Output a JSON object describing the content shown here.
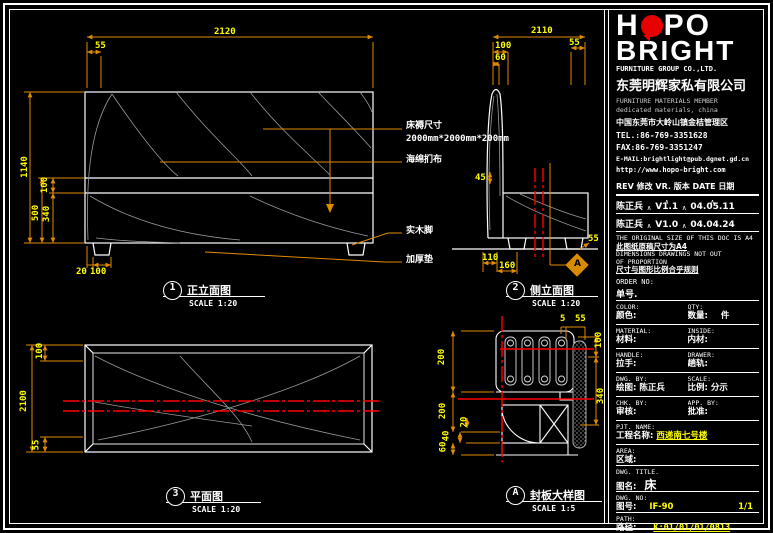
{
  "logo": {
    "l1a": "H",
    "l1b": "PO",
    "line2": "BRIGHT",
    "subtitle": "FURNITURE GROUP CO.,LTD.",
    "company_cn": "东莞明辉家私有限公司",
    "desc1": "FURNITURE MATERIALS MEMBER",
    "desc2": "dedicated materials, china",
    "address": "中国东莞市大岭山镇金桔管理区",
    "tel": "TEL.:86-769-3351628",
    "fax": "FAX:86-769-3351247",
    "email": "E-MAIL:brightlight@pub.dgnet.gd.cn",
    "web": "http://www.hopo-bright.com"
  },
  "rev": {
    "header": "REV 修改   VR. 版本   DATE 日期",
    "caret": "∧",
    "rows": [
      {
        "by": "陈正兵",
        "ver": "V1.1",
        "date": "04.05.11"
      },
      {
        "by": "陈正兵",
        "ver": "V1.0",
        "date": "04.04.24"
      }
    ]
  },
  "notes": {
    "en1": "THE ORIGINAL SIZE OF THIS DOC IS A4",
    "cn1": "此图纸原稿尺寸为A4",
    "en2": "DIMENSIONS DRAWINGS NOT OUT",
    "en3": "OF PROPORTION",
    "cn2": "尺寸与图形比例合乎规则"
  },
  "tb": {
    "order_en": "ORDER NO:",
    "order_cn": "单号.",
    "rows": [
      {
        "en1": "COLOR:",
        "en2": "QTY:",
        "cn1": "颜色:",
        "val1": "",
        "cn2": "数量:",
        "val2": "件"
      },
      {
        "en1": "MATERIAL:",
        "en2": "INSIDE:",
        "cn1": "材料:",
        "val1": "",
        "cn2": "内材:",
        "val2": ""
      },
      {
        "en1": "HANDLE:",
        "en2": "DRAWER:",
        "cn1": "拉手:",
        "val1": "",
        "cn2": "趟轨:",
        "val2": ""
      },
      {
        "en1": "DWG. BY:",
        "en2": "SCALE:",
        "cn1": "绘图:",
        "val1": "陈正兵",
        "cn2": "比例:",
        "val2": "分示"
      },
      {
        "en1": "CHK. BY:",
        "en2": "APP. BY:",
        "cn1": "审核:",
        "val1": "",
        "cn2": "批准:",
        "val2": ""
      }
    ],
    "pjt": {
      "en": "PJT. NAME:",
      "cn": "工程名称:",
      "val": "西递南七号楼"
    },
    "area": {
      "en": "AREA:",
      "cn": "区域:"
    },
    "title": {
      "en": "DWG. TITLE.",
      "cn": "图名:",
      "val": "床"
    },
    "no": {
      "en": "DWG. NO:",
      "cn": "图号:",
      "val": "IF-90",
      "page": "1/1"
    },
    "path": {
      "en": "PATH:",
      "cn": "路径:",
      "val": "K:01/01/01/0813"
    }
  },
  "views": {
    "front": {
      "num": "1",
      "title": "正立面图",
      "scale": "SCALE 1:20"
    },
    "side": {
      "num": "2",
      "title": "侧立面图",
      "scale": "SCALE 1:20"
    },
    "plan": {
      "num": "3",
      "title": "平面图",
      "scale": "SCALE 1:20"
    },
    "detail": {
      "num": "A",
      "title": "封板大样图",
      "scale": "SCALE 1:5"
    },
    "section_marker": "A"
  },
  "annotations": {
    "mattress1": "床褥尺寸",
    "mattress2": "2000mm*2000mm*200mm",
    "sponge": "海绵扪布",
    "leg": "实木脚",
    "pad": "加厚垫"
  },
  "dims": {
    "front": {
      "width": "2120",
      "left_offset": "55",
      "height": "1140",
      "seam": "100",
      "lower": "500",
      "cushion": "340",
      "leg_inset": "20",
      "leg_width": "100"
    },
    "side": {
      "length": "2110",
      "top_a": "100",
      "top_b": "60",
      "top_right": "55",
      "post": "45",
      "bottom_right": "55",
      "leg_a": "110",
      "leg_b": "160"
    },
    "plan": {
      "top": "100",
      "length": "2100",
      "bottom": "55"
    },
    "detail": {
      "top_a": "5",
      "top_b": "55",
      "left_a": "200",
      "left_b": "200",
      "left_c": "20",
      "left_d": "40",
      "left_e": "60",
      "right_a": "100",
      "right_b": "340"
    }
  },
  "colors": {
    "dim_text": "#ffff00",
    "dim_line": "#e08a00",
    "section_red": "#ff0000",
    "logo_red": "#e60000"
  }
}
